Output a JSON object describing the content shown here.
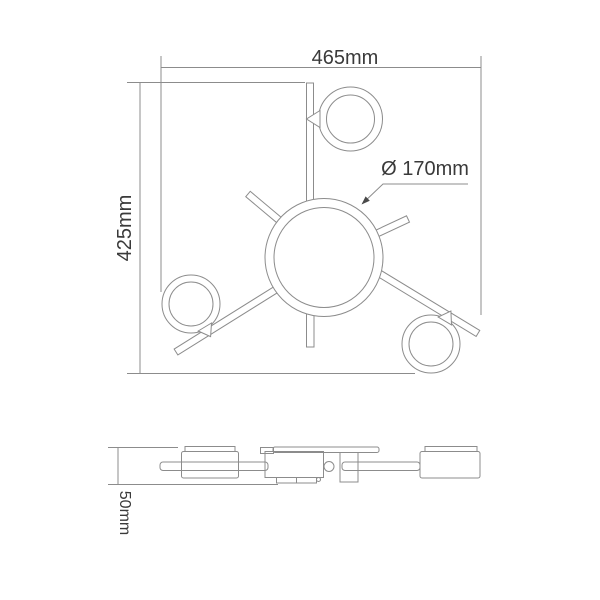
{
  "drawing": {
    "top_view": {
      "width_label": "465mm",
      "height_label": "425mm",
      "diameter_label": "Ø 170mm"
    },
    "side_view": {
      "height_label": "50mm"
    }
  },
  "colors": {
    "background": "#ffffff",
    "line": "#8c8c8c",
    "text": "#3a3a3a",
    "arrowhead": "#4a4a4a"
  }
}
